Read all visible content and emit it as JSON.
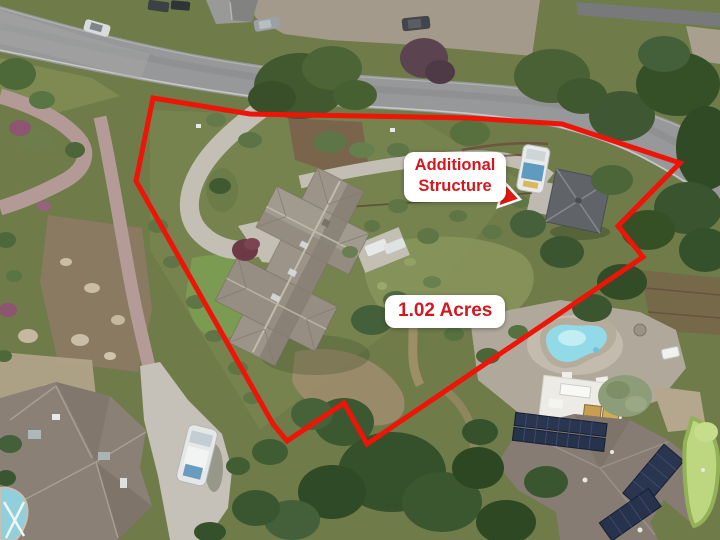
{
  "annotations": {
    "boundary": {
      "points": "153,98 250,114 470,118 562,124 680,163 618,226 643,257 367,444 344,403 287,441 273,424 136,181",
      "color": "#ee1408",
      "stroke_width": "5"
    },
    "structure_label": {
      "line1": "Additional",
      "line2": "Structure",
      "text_color": "#d2191f",
      "bg_color": "#ffffff"
    },
    "arrow": {
      "points": "480.1,184.6 503.4,190.4 504.8,184.6 517.8,198.7 499.7,205 501.2,199.2 477.9,193.4",
      "fill": "#e6150d",
      "outline": "#ffffff"
    },
    "acreage_label": {
      "text": "1.02 Acres",
      "text_color": "#d2191f",
      "bg_color": "#ffffff"
    }
  }
}
